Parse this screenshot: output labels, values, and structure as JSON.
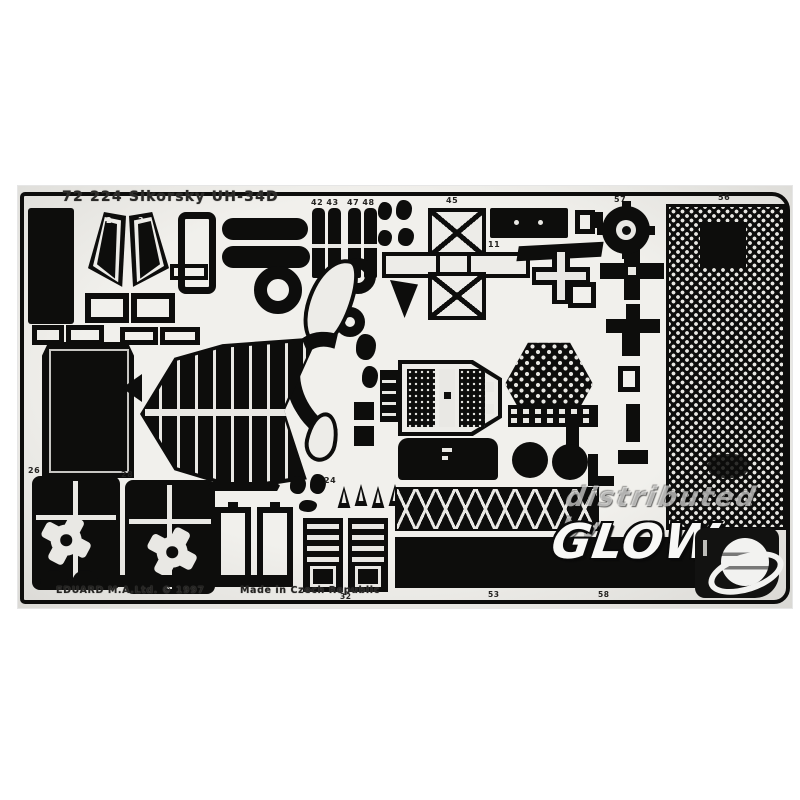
{
  "product": {
    "title": "72 224 Sikorsky UH-34D",
    "maker_line": "EDUARD M.A.Ltd. © 1997",
    "origin_line": "Made in Czech Republic"
  },
  "watermark": {
    "distributed_by": "distributed by",
    "brand": "GLOW",
    "logo": "globe-swoosh-logo"
  },
  "part_labels": {
    "p2": "2",
    "p3": "3",
    "seats_left": "42 43",
    "seats_right": "47 48",
    "p45": "45",
    "p11": "11",
    "p56": "56",
    "p57": "57",
    "p24": "24",
    "p26": "26",
    "p28": "28",
    "p32": "32",
    "p53": "53",
    "p58": "58"
  },
  "colors": {
    "page_bg": "#ffffff",
    "sheet": "#edece8",
    "etched_part": "#0d0d0c",
    "watermark_white": "#f7f7f5"
  }
}
